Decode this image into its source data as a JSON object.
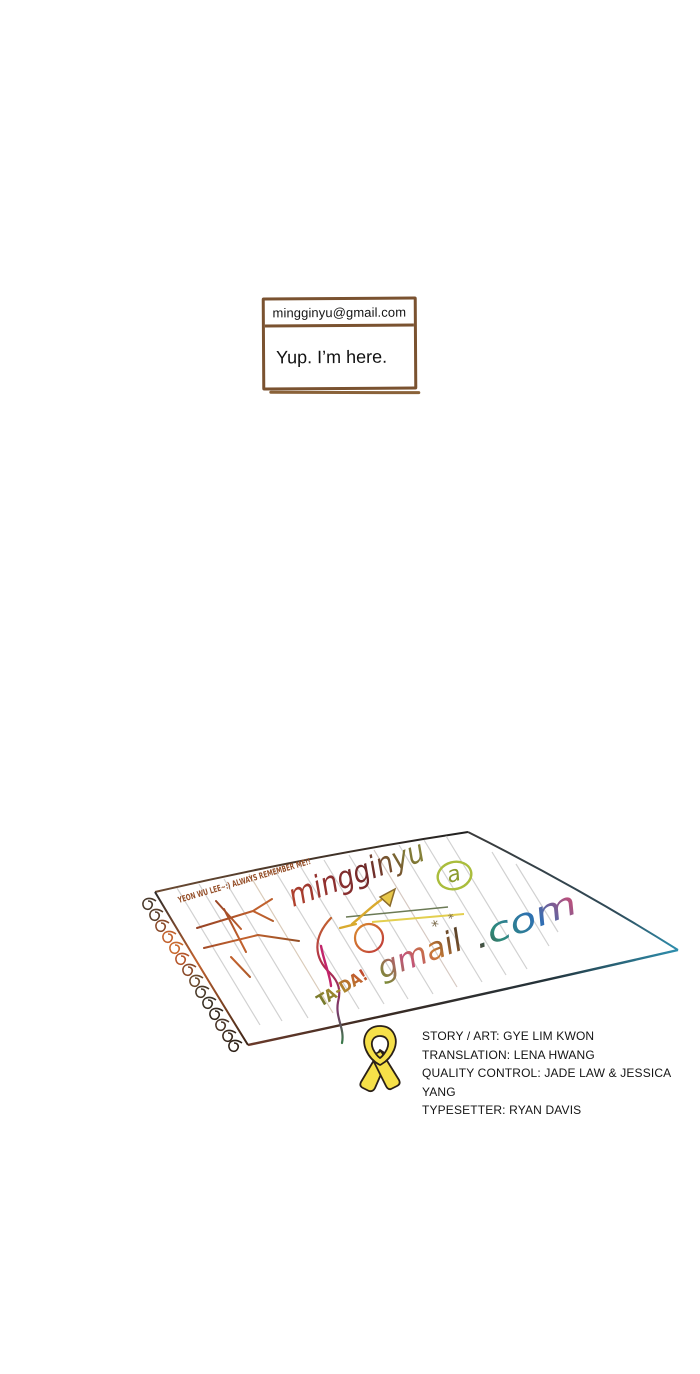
{
  "dialogue": {
    "email_label": "mingginyu@gmail.com",
    "reply_text": "Yup. I’m here."
  },
  "notebook": {
    "corner_note": "YEON WU LEE~:) ALWAYS REMEMBER ME!!",
    "email_word": "mingginyu",
    "at_symbol": "a",
    "domain_word": "gmail",
    "tld_word": ".com",
    "exclaim": "TA-DA!",
    "sparkle_left": "*",
    "sparkle_right": "*"
  },
  "credits": {
    "lines": [
      "STORY / ART: GYE LIM KWON",
      "TRANSLATION: LENA HWANG",
      "QUALITY CONTROL: JADE LAW & JESSICA YANG",
      "TYPESETTER: RYAN DAVIS"
    ]
  },
  "colors": {
    "box_border": "#7a5230",
    "ribbon_fill": "#f6e049",
    "ribbon_outline": "#2a2018",
    "paper_edge_blue": "#2e8fae",
    "paper_edge_brown": "#6b3a2a",
    "handwriting_red": "#b4432d",
    "handwriting_olive": "#8f9040",
    "handwriting_blue": "#2e6fb5",
    "handwriting_pink": "#c75b8a"
  }
}
